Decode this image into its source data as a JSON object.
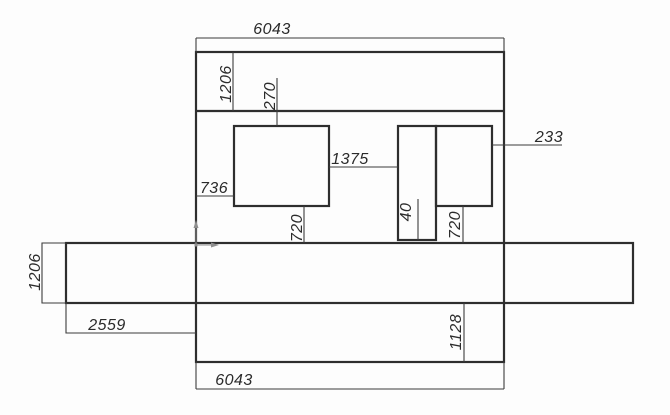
{
  "drawing": {
    "type": "cad-dimension-drawing",
    "background_color": "#fdfdfd",
    "line_color": "#2e2e2e",
    "thin_line_color": "#3c3c3c",
    "text_color": "#2b2b2b",
    "axis_icon_color": "#8f8f8f",
    "dims": {
      "top_width": "6043",
      "top_strip_height": "1206",
      "inner_top_offset": "270",
      "left_inset": "736",
      "center_gap": "1375",
      "right_edge_gap": "233",
      "partition_thickness": "40",
      "left_drop": "720",
      "right_drop": "720",
      "band_height": "1206",
      "left_overhang": "2559",
      "bottom_strip_height": "1128",
      "bottom_width": "6043"
    },
    "icons": {
      "origin_marker": "ucs-origin-axes-icon"
    }
  }
}
